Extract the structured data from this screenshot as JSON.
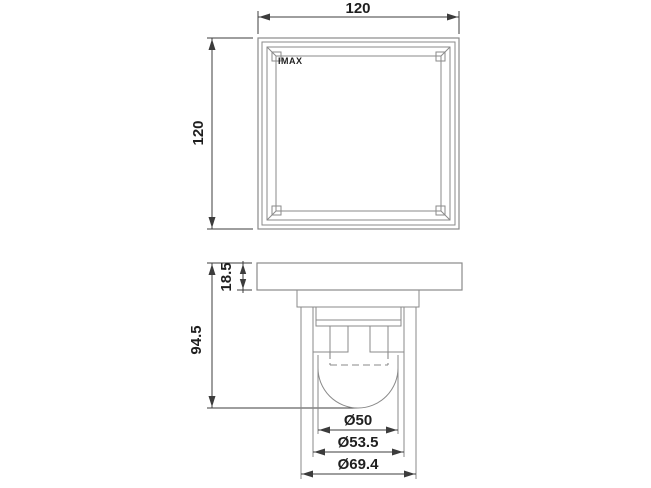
{
  "drawing": {
    "logo": "IMAX",
    "top_view": {
      "width_dim": "120",
      "height_dim": "120"
    },
    "side_view": {
      "flange_height_dim": "18.5",
      "overall_height_dim": "94.5",
      "inner_diameter_dim": "Ø50",
      "middle_diameter_dim": "Ø53.5",
      "outer_diameter_dim": "Ø69.4"
    },
    "colors": {
      "bg": "#ffffff",
      "part-line": "#8a8a8a",
      "dim-line": "#3c3c3c",
      "text-color": "#1f1f1f"
    }
  }
}
